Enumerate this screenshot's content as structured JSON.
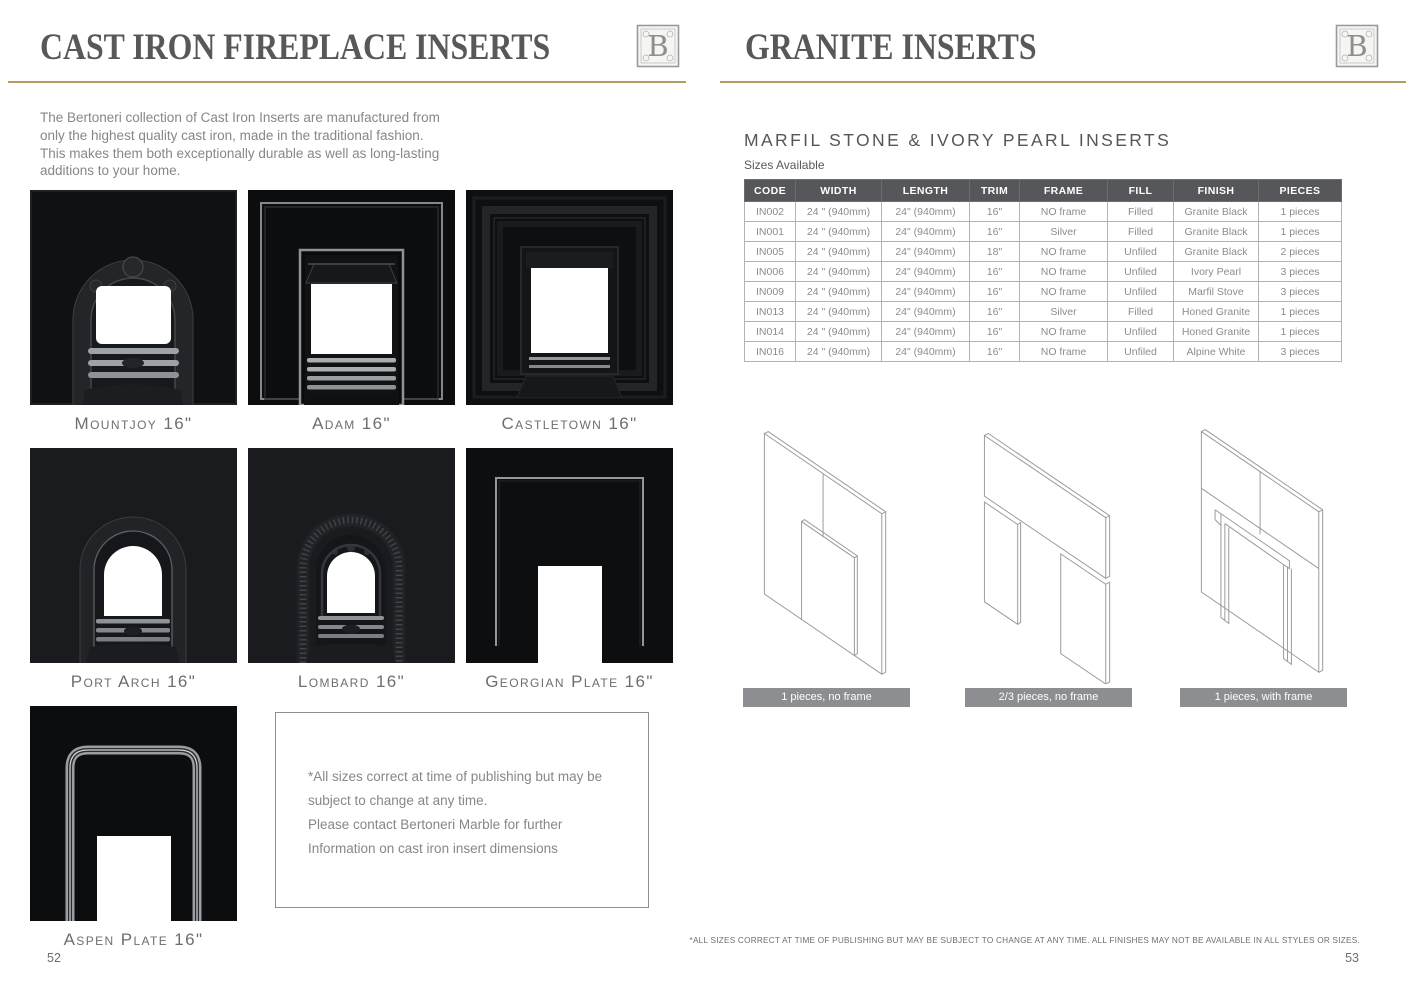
{
  "left_page": {
    "title": "CAST IRON FIREPLACE INSERTS",
    "intro": "The Bertoneri collection of Cast Iron Inserts are manufactured from only the highest quality cast iron, made in the traditional fashion. This makes them both exceptionally durable as well as long-lasting additions to your home.",
    "products": [
      {
        "label": "Mountjoy 16\""
      },
      {
        "label": "Adam 16\""
      },
      {
        "label": "Castletown 16\""
      },
      {
        "label": "Port Arch 16\""
      },
      {
        "label": "Lombard 16\""
      },
      {
        "label": "Georgian Plate 16\""
      },
      {
        "label": "Aspen Plate 16\""
      }
    ],
    "note": "*All sizes correct at time of publishing but may be  subject to change at any time.\nPlease contact Bertoneri Marble for further Information on cast iron insert dimensions",
    "page_number": "52"
  },
  "right_page": {
    "title": "GRANITE INSERTS",
    "section_title": "MARFIL STONE & IVORY PEARL INSERTS",
    "sizes_label": "Sizes Available",
    "table": {
      "headers": [
        "CODE",
        "WIDTH",
        "LENGTH",
        "TRIM",
        "FRAME",
        "FILL",
        "FINISH",
        "PIECES"
      ],
      "rows": [
        [
          "IN002",
          "24 \" (940mm)",
          "24\" (940mm)",
          "16\"",
          "NO frame",
          "Filled",
          "Granite Black",
          "1 pieces"
        ],
        [
          "IN001",
          "24 \" (940mm)",
          "24\" (940mm)",
          "16\"",
          "Silver",
          "Filled",
          "Granite Black",
          "1 pieces"
        ],
        [
          "IN005",
          "24 \" (940mm)",
          "24\" (940mm)",
          "18\"",
          "NO frame",
          "Unfiled",
          "Granite Black",
          "2 pieces"
        ],
        [
          "IN006",
          "24 \" (940mm)",
          "24\" (940mm)",
          "16\"",
          "NO frame",
          "Unfiled",
          "Ivory Pearl",
          "3 pieces"
        ],
        [
          "IN009",
          "24 \" (940mm)",
          "24\" (940mm)",
          "16\"",
          "NO frame",
          "Unfiled",
          "Marfil Stove",
          "3 pieces"
        ],
        [
          "IN013",
          "24 \" (940mm)",
          "24\" (940mm)",
          "16\"",
          "Silver",
          "Filled",
          "Honed Granite",
          "1 pieces"
        ],
        [
          "IN014",
          "24 \" (940mm)",
          "24\" (940mm)",
          "16\"",
          "NO frame",
          "Unfiled",
          "Honed Granite",
          "1 pieces"
        ],
        [
          "IN016",
          "24 \" (940mm)",
          "24\" (940mm)",
          "16\"",
          "NO frame",
          "Unfiled",
          "Alpine White",
          "3 pieces"
        ]
      ]
    },
    "figures": [
      {
        "caption": "1 pieces, no frame"
      },
      {
        "caption": "2/3 pieces, no frame"
      },
      {
        "caption": "1 pieces, with frame"
      }
    ],
    "footnote": "*ALL SIZES CORRECT AT TIME OF PUBLISHING BUT MAY BE SUBJECT TO CHANGE AT ANY TIME. ALL FINISHES MAY NOT BE AVAILABLE IN ALL STYLES OR SIZES.",
    "page_number": "53"
  },
  "logo_letter": "B",
  "colors": {
    "accent_gold": "#b49d62",
    "heading_gray": "#57585a",
    "table_header_bg": "#55575a",
    "caption_bar": "#8d8e91"
  }
}
